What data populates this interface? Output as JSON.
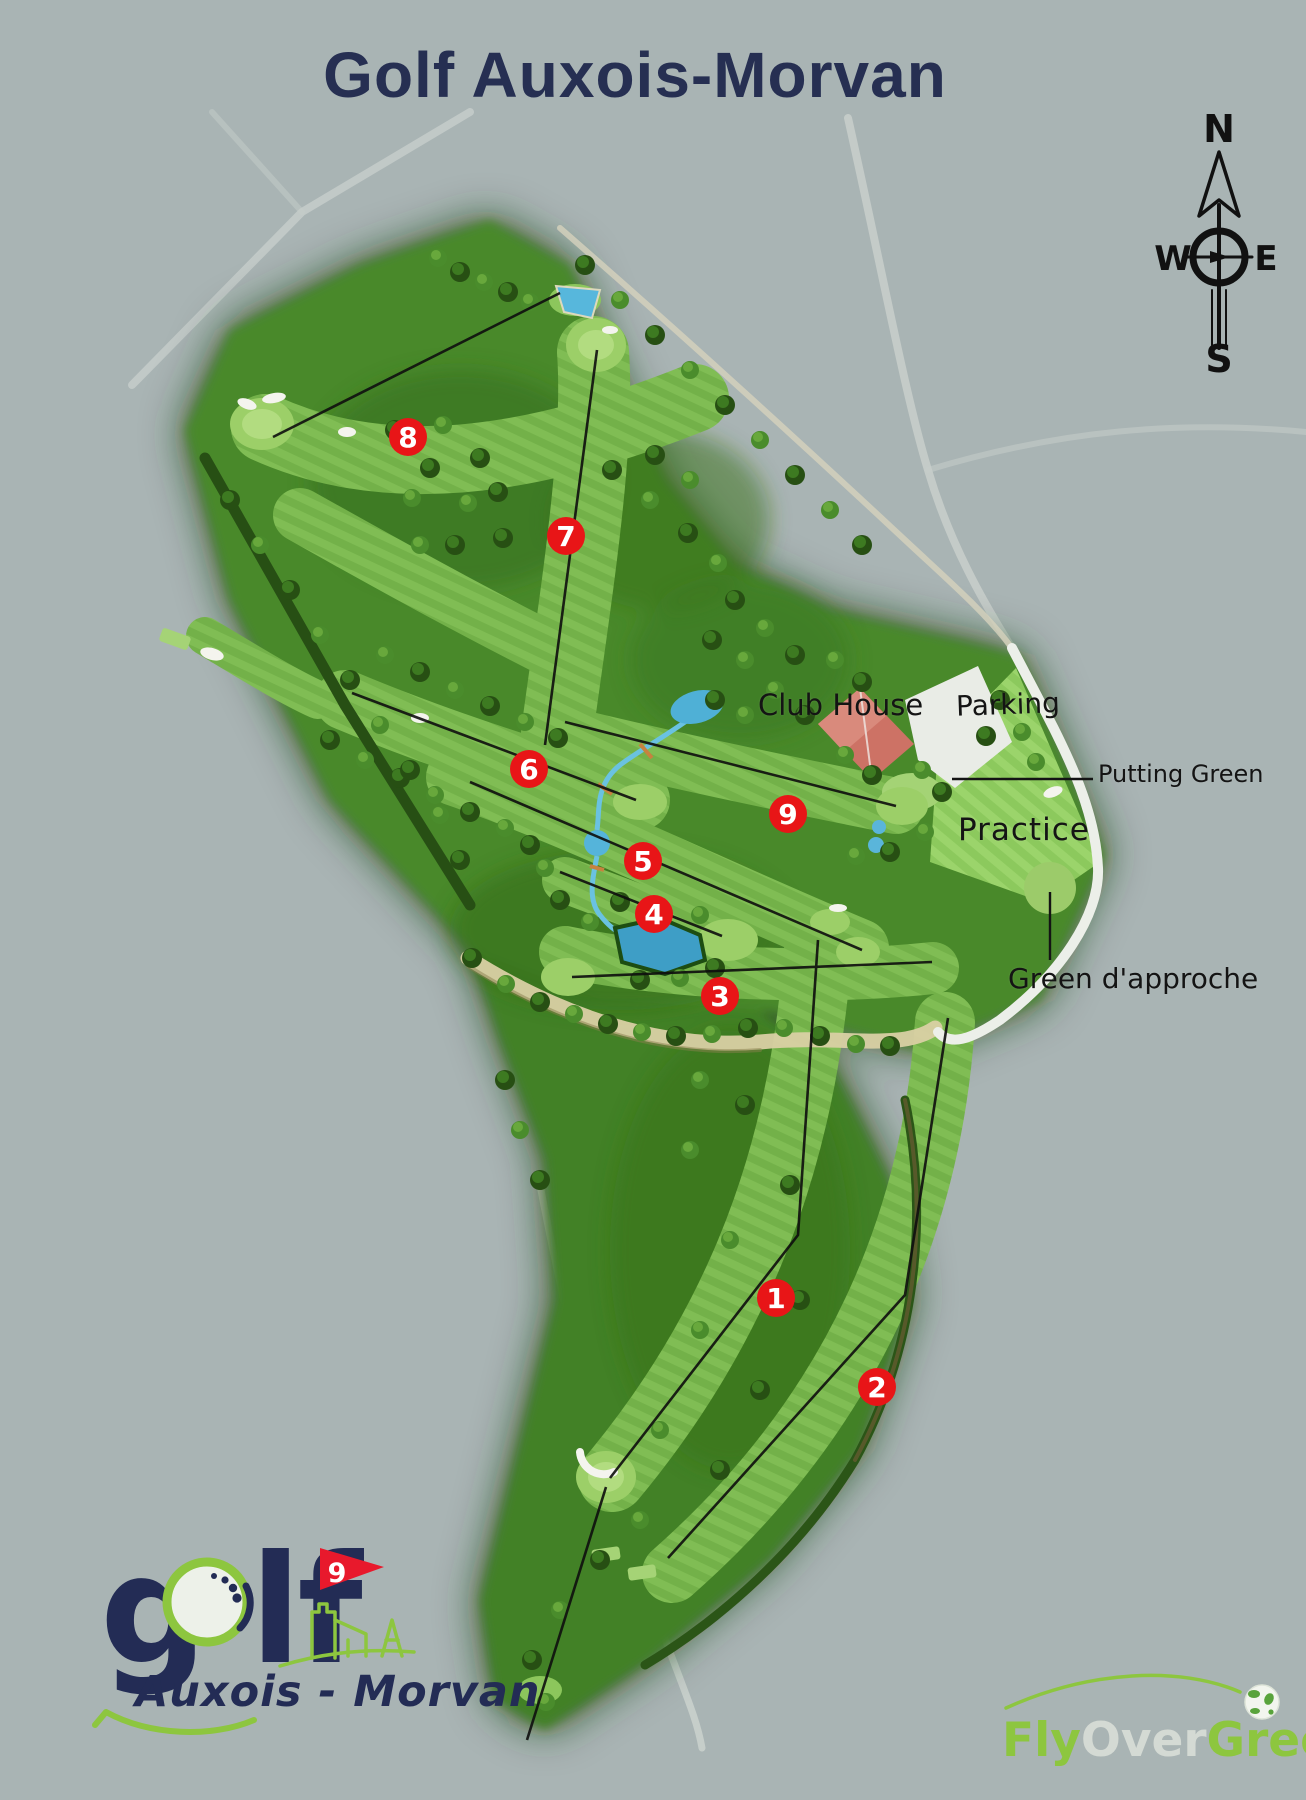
{
  "title": "Golf Auxois-Morvan",
  "compass": {
    "n": "N",
    "e": "E",
    "s": "S",
    "w": "W"
  },
  "map": {
    "labels": {
      "club_house": "Club House",
      "parking": "Parking",
      "putting_green": "Putting Green",
      "practice": "Practice",
      "green_approche": "Green d'approche"
    },
    "markers": [
      {
        "label": "1",
        "x": 776,
        "y": 1298
      },
      {
        "label": "2",
        "x": 877,
        "y": 1387
      },
      {
        "label": "3",
        "x": 720,
        "y": 996
      },
      {
        "label": "4",
        "x": 654,
        "y": 914
      },
      {
        "label": "5",
        "x": 643,
        "y": 861
      },
      {
        "label": "6",
        "x": 529,
        "y": 769
      },
      {
        "label": "7",
        "x": 566,
        "y": 536
      },
      {
        "label": "8",
        "x": 408,
        "y": 437
      },
      {
        "label": "9",
        "x": 788,
        "y": 814
      }
    ]
  },
  "logo": {
    "word_start": "g",
    "word_end": "lf",
    "flag_number": "9",
    "subtitle": "Auxois - Morvan"
  },
  "watermark": {
    "fly": "Fly",
    "over": "Over",
    "green": "Green"
  },
  "colors": {
    "marker_red": "#e81517",
    "title_navy": "#262f52",
    "logo_navy": "#232c55",
    "logo_green": "#8dc63f",
    "watermark_gray": "#d9ded7",
    "course_dark": "#173f0b"
  }
}
